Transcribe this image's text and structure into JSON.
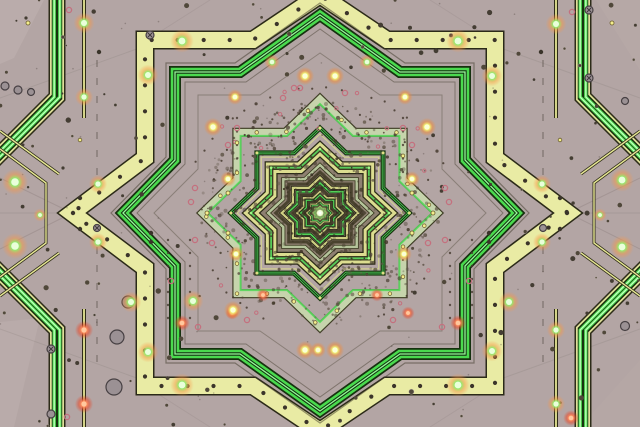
{
  "image": {
    "width": 640,
    "height": 427,
    "kind": "kaleidoscope-circuit-star-fractal"
  },
  "center": {
    "x": 320,
    "y": 213
  },
  "palette": {
    "background": "#b3a5a4",
    "background_inner": "#a89b9a",
    "yellow_band": "#e9eba4",
    "yellow_band_edge": "#2b2a18",
    "green_bright": "#4ada4e",
    "green_light": "#96fb9a",
    "green_dark": "#16320f",
    "sage_band": "#c6d4ac",
    "sage_edge": "#3a3a20",
    "thin_yellow": "#e6e794",
    "mottle_brown": "#8e8071",
    "inner_olive": "#5e5641",
    "center_glow": "#f2ffda",
    "glow_halo_warm": "#f08c3c",
    "pink_ring": "#c4707e",
    "gray_circle": "#9b9194",
    "dark_dot": "#443d33"
  },
  "gradients": {
    "glow_yellow": [
      "#ffffe0",
      "#f2fa7a",
      "rgba(240,140,60,0.55)",
      "rgba(240,140,60,0)"
    ],
    "glow_green": [
      "#f0ffd8",
      "#90ee70",
      "rgba(250,150,70,0.45)",
      "rgba(250,150,70,0)"
    ],
    "glow_red": [
      "#ffd8b8",
      "#ff9060",
      "rgba(230,70,40,0.5)",
      "rgba(230,70,40,0)"
    ],
    "center": [
      "#eaffc8",
      "rgba(168,216,122,0.35)",
      "rgba(168,216,122,0)"
    ]
  },
  "patches": [
    {
      "pts": [
        [
          0,
          0
        ],
        [
          44,
          0
        ],
        [
          14,
          58
        ],
        [
          0,
          64
        ]
      ],
      "c": "#c1b3b1",
      "op": 0.5
    },
    {
      "pts": [
        [
          0,
          322
        ],
        [
          40,
          318
        ],
        [
          14,
          427
        ],
        [
          0,
          427
        ]
      ],
      "c": "#bfb1af",
      "op": 0.5
    },
    {
      "pts": [
        [
          596,
          0
        ],
        [
          640,
          0
        ],
        [
          640,
          70
        ]
      ],
      "c": "#bbadab",
      "op": 0.4
    },
    {
      "pts": [
        [
          640,
          360
        ],
        [
          640,
          427
        ],
        [
          580,
          427
        ]
      ],
      "c": "#b9abaa",
      "op": 0.35
    }
  ],
  "seams": [
    [
      72,
      213,
      0,
      178,
      0.13
    ],
    [
      72,
      213,
      0,
      249,
      0.13
    ],
    [
      568,
      213,
      640,
      178,
      0.13
    ],
    [
      568,
      213,
      640,
      249,
      0.13
    ],
    [
      320,
      0,
      320,
      16,
      0.18
    ],
    [
      320,
      410,
      320,
      427,
      0.18
    ],
    [
      0,
      213,
      70,
      213,
      0.1
    ],
    [
      573,
      213,
      640,
      213,
      0.1
    ],
    [
      0,
      98,
      145,
      46,
      0.09
    ],
    [
      640,
      98,
      495,
      46,
      0.09
    ],
    [
      0,
      329,
      145,
      381,
      0.09
    ],
    [
      640,
      329,
      495,
      381,
      0.09
    ],
    [
      147,
      40,
      210,
      0,
      0.08
    ],
    [
      493,
      40,
      430,
      0,
      0.08
    ],
    [
      147,
      387,
      210,
      427,
      0.08
    ],
    [
      493,
      387,
      430,
      427,
      0.08
    ]
  ],
  "edge_right": {
    "thin_line": {
      "x": 556,
      "segs": [
        [
          -4,
          118
        ],
        [
          309,
          432
        ]
      ],
      "strokes": [
        [
          4,
          "#2f2c1a"
        ],
        [
          1.8,
          "#e6e794"
        ]
      ]
    },
    "dash_line": {
      "x": 543,
      "segs": [
        [
          60,
          180
        ],
        [
          247,
          367
        ]
      ],
      "w": 1.2,
      "c": "#4a4238",
      "dash": "7 11",
      "op": 0.5
    },
    "band_paths": [
      [
        [
          583,
          -4
        ],
        [
          583,
          97
        ],
        [
          650,
          164
        ]
      ],
      [
        [
          650,
          263
        ],
        [
          583,
          330
        ],
        [
          583,
          432
        ]
      ]
    ],
    "band_strokes": [
      [
        17,
        "#2c2c18"
      ],
      [
        14,
        "#dfe098"
      ],
      [
        10.5,
        "#17320e"
      ]
    ],
    "band_line_offset": 2.8,
    "band_line_strokes": [
      [
        3.2,
        "#57e75b"
      ],
      [
        1.1,
        "#ccffc6"
      ]
    ],
    "diagonals": [
      [
        [
          640,
          131
        ],
        [
          581,
          174
        ]
      ],
      [
        [
          640,
          149
        ],
        [
          594,
          183
        ],
        [
          594,
          243
        ],
        [
          640,
          277
        ]
      ],
      [
        [
          640,
          296
        ],
        [
          581,
          253
        ]
      ]
    ],
    "diag_strokes": [
      [
        3,
        "#2f2c1a"
      ],
      [
        1.4,
        "#e6e794"
      ]
    ]
  },
  "outer_rings": [
    {
      "A": 228,
      "dx": 70,
      "F": 181,
      "W": 183,
      "V": 58,
      "T": 259,
      "strokes": [
        [
          1.3,
          "#3e3828",
          0.55
        ]
      ]
    },
    {
      "A": 218,
      "dx": 67,
      "F": 173,
      "W": 175,
      "V": 55,
      "T": 248,
      "strokes": [
        [
          19,
          "#2b2a18"
        ],
        [
          16,
          "#e9eba4"
        ]
      ],
      "dots": {
        "step": 26,
        "r": 2.1,
        "c": "#3b342a"
      }
    },
    {
      "A": 210,
      "dx": 85,
      "F": 150,
      "W": 154,
      "V": 56,
      "T": 209,
      "strokes": [
        [
          1.2,
          "#3e3828",
          0.5
        ]
      ]
    },
    {
      "A": 198,
      "dx": 80,
      "F": 141,
      "W": 145,
      "V": 53,
      "T": 197,
      "strokes": [
        [
          12,
          "#16320f"
        ],
        [
          8.5,
          "#4ada4e"
        ],
        [
          3.4,
          "#133110"
        ],
        [
          1.3,
          "#96fb9a"
        ]
      ]
    },
    {
      "A": 184,
      "dx": 74,
      "F": 131,
      "W": 135,
      "V": 49,
      "T": 183,
      "strokes": [
        [
          1,
          "#3e3828",
          0.45
        ]
      ]
    },
    {
      "A": 160,
      "dx": 60,
      "F": 118,
      "W": 122,
      "V": 44,
      "T": 166,
      "strokes": [
        [
          1,
          "#3e3828",
          0.35
        ]
      ]
    }
  ],
  "fills": [
    {
      "R": 62,
      "c": "#8e8071"
    },
    {
      "R": 42,
      "c": "#7b6f5c"
    },
    {
      "R": 27,
      "c": "#6a6150"
    },
    {
      "R": 16,
      "c": "#5e5641"
    },
    {
      "R": 9,
      "c": "#575134"
    }
  ],
  "inner_rings": [
    {
      "R": 120,
      "s": 1.03,
      "strokes": [
        [
          1,
          "#3e3828",
          0.4
        ]
      ]
    },
    {
      "R": 114,
      "s": 1.03,
      "strokes": [
        [
          9,
          "#3a3a20"
        ],
        [
          7,
          "#c6d4ac"
        ]
      ],
      "path_dots": {
        "step": 30,
        "r": 1.8,
        "fill": "#f2ec8e",
        "stroke": "#6a5c30"
      }
    },
    {
      "R": 109,
      "s": 1.03,
      "strokes": [
        [
          2,
          "#58d85c",
          0.9
        ]
      ]
    },
    {
      "R": 85,
      "s": 1.05,
      "strokes": [
        [
          5,
          "#17320e"
        ],
        [
          2.6,
          "#4fc957"
        ],
        [
          0.9,
          "#0e2a0c"
        ]
      ],
      "tip_dots": {
        "r": 1.5,
        "c": "#f2ec8e"
      }
    },
    {
      "R": 79,
      "s": 1.05,
      "strokes": [
        [
          1.2,
          "#d8d98c",
          0.8
        ]
      ]
    },
    {
      "R": 64,
      "s": 1.08,
      "strokes": [
        [
          13,
          "#2b2a18"
        ],
        [
          10.5,
          "#dcdd90"
        ],
        [
          4.5,
          "#3c3a20"
        ],
        [
          1.8,
          "#57cb59"
        ]
      ],
      "path_dots": {
        "step": 13,
        "r": 0.8,
        "fill": "#3c3626"
      },
      "tip_dots": {
        "r": 1.3,
        "c": "#a8ff8c"
      }
    },
    {
      "R": 48,
      "s": 1.08,
      "strokes": [
        [
          4,
          "#333218"
        ],
        [
          2.5,
          "#b5c49b"
        ]
      ]
    },
    {
      "R": 41,
      "s": 1.08,
      "strokes": [
        [
          3,
          "#4a432f"
        ]
      ]
    },
    {
      "R": 35.5,
      "s": 1.08,
      "strokes": [
        [
          4,
          "#2b2918"
        ],
        [
          2.2,
          "#cfd084"
        ]
      ]
    },
    {
      "R": 30,
      "s": 1.08,
      "strokes": [
        [
          3,
          "#143010"
        ],
        [
          1.6,
          "#54d058"
        ]
      ]
    },
    {
      "R": 25.5,
      "s": 1.08,
      "strokes": [
        [
          2.5,
          "#453e2a"
        ]
      ]
    },
    {
      "R": 21.5,
      "s": 1.08,
      "strokes": [
        [
          3,
          "#2b2918"
        ],
        [
          1.6,
          "#c8c97e"
        ]
      ]
    },
    {
      "R": 18,
      "s": 1.08,
      "strokes": [
        [
          2.2,
          "#143010"
        ],
        [
          1.2,
          "#54d058"
        ]
      ]
    },
    {
      "R": 15,
      "s": 1.08,
      "strokes": [
        [
          2,
          "#453e2a"
        ]
      ]
    },
    {
      "R": 12.4,
      "s": 1.08,
      "strokes": [
        [
          2.2,
          "#2b2918"
        ],
        [
          1.2,
          "#c2c378"
        ]
      ]
    },
    {
      "R": 10.2,
      "s": 1.08,
      "strokes": [
        [
          1.8,
          "#143010"
        ],
        [
          1,
          "#58d05c"
        ]
      ]
    },
    {
      "R": 8.4,
      "s": 1.08,
      "strokes": [
        [
          1.5,
          "#40392a"
        ]
      ]
    },
    {
      "R": 6.8,
      "s": 1.08,
      "strokes": [
        [
          1.6,
          "#2b2918"
        ],
        [
          0.9,
          "#bcbd72"
        ]
      ]
    },
    {
      "R": 5.4,
      "s": 1.08,
      "strokes": [
        [
          1.4,
          "#143010"
        ],
        [
          0.8,
          "#58d05c"
        ]
      ]
    },
    {
      "R": 4.3,
      "s": 1.08,
      "strokes": [
        [
          1.2,
          "#3a3426"
        ]
      ]
    },
    {
      "R": 3.4,
      "s": 1.08,
      "strokes": [
        [
          1.2,
          "#2b2918"
        ],
        [
          0.7,
          "#b6b76c"
        ]
      ]
    },
    {
      "R": 2.6,
      "s": 1.08,
      "strokes": [
        [
          1,
          "#343022"
        ]
      ]
    },
    {
      "R": 1.9,
      "s": 1.08,
      "strokes": [
        [
          1,
          "#4ec455"
        ]
      ]
    }
  ],
  "chains": {
    "arcs": [
      [
        320,
        216,
        108,
        200,
        340,
        26
      ],
      [
        320,
        216,
        128,
        205,
        335,
        22
      ],
      [
        320,
        216,
        88,
        215,
        325,
        15
      ],
      [
        320,
        216,
        115,
        118,
        152,
        9
      ],
      [
        320,
        216,
        115,
        28,
        62,
        9
      ]
    ],
    "lines": [
      [
        403,
        118,
        403,
        172,
        5
      ],
      [
        237,
        118,
        237,
        172,
        5
      ],
      [
        168,
        240,
        168,
        318,
        7
      ],
      [
        190,
        240,
        190,
        318,
        7
      ],
      [
        472,
        240,
        472,
        318,
        7
      ],
      [
        450,
        240,
        450,
        318,
        7
      ]
    ]
  },
  "dots": {
    "glow_green": [
      [
        84,
        23,
        4
      ],
      [
        84,
        97,
        3.5
      ],
      [
        15,
        182,
        5
      ],
      [
        15,
        246,
        5
      ],
      [
        98,
        184,
        3.5
      ],
      [
        98,
        242,
        3.5
      ],
      [
        148,
        75,
        4
      ],
      [
        182,
        41,
        4.5
      ],
      [
        131,
        302,
        4
      ],
      [
        148,
        352,
        4
      ],
      [
        182,
        385,
        4.5
      ],
      [
        272,
        62,
        3
      ],
      [
        367,
        62,
        3
      ],
      [
        600,
        215,
        2.5
      ],
      [
        40,
        215,
        2.5
      ],
      [
        622,
        180,
        4.5
      ],
      [
        622,
        247,
        4.5
      ],
      [
        556,
        24,
        4
      ],
      [
        556,
        330,
        3.5
      ],
      [
        556,
        404,
        3.5
      ],
      [
        492,
        76,
        4
      ],
      [
        492,
        351,
        4
      ],
      [
        542,
        184,
        3.5
      ],
      [
        542,
        242,
        3.5
      ],
      [
        458,
        41,
        4.5
      ],
      [
        509,
        302,
        4
      ],
      [
        458,
        385,
        4.5
      ],
      [
        193,
        301,
        4
      ]
    ],
    "glow_yellow": [
      [
        305,
        76,
        3.5
      ],
      [
        335,
        76,
        3.5
      ],
      [
        305,
        350,
        3.5
      ],
      [
        318,
        350,
        3
      ],
      [
        335,
        350,
        3.5
      ],
      [
        213,
        127,
        3.5
      ],
      [
        235,
        97,
        3
      ],
      [
        233,
        310,
        3.5
      ],
      [
        405,
        97,
        3
      ],
      [
        427,
        127,
        3.5
      ],
      [
        412,
        179,
        3
      ],
      [
        228,
        179,
        3
      ],
      [
        404,
        254,
        3
      ],
      [
        236,
        254,
        3
      ]
    ],
    "glow_red": [
      [
        84,
        330,
        3.5
      ],
      [
        84,
        404,
        3.5
      ],
      [
        571,
        418,
        3
      ],
      [
        182,
        323,
        3
      ],
      [
        458,
        323,
        3
      ],
      [
        263,
        295,
        2.5
      ],
      [
        377,
        295,
        2.5
      ],
      [
        232,
        313,
        2.5
      ],
      [
        408,
        313,
        2.5
      ]
    ],
    "pink_rings": [
      [
        69,
        10
      ],
      [
        572,
        12
      ],
      [
        67,
        417
      ],
      [
        294,
        88
      ],
      [
        300,
        88
      ],
      [
        283,
        98
      ],
      [
        345,
        93
      ],
      [
        403,
        128
      ],
      [
        237,
        128
      ],
      [
        412,
        145
      ],
      [
        228,
        145
      ],
      [
        445,
        188
      ],
      [
        195,
        188
      ],
      [
        445,
        240
      ],
      [
        195,
        240
      ],
      [
        212,
        243
      ],
      [
        428,
        243
      ],
      [
        171,
        281
      ],
      [
        469,
        281
      ],
      [
        247,
        320
      ],
      [
        393,
        320
      ],
      [
        198,
        327
      ],
      [
        442,
        327
      ],
      [
        449,
        202
      ],
      [
        191,
        202
      ]
    ],
    "yellow_rings": [
      [
        612,
        23,
        2
      ],
      [
        28,
        23,
        2
      ],
      [
        412,
        193,
        2
      ],
      [
        412,
        233,
        2
      ],
      [
        433,
        213,
        2
      ],
      [
        228,
        193,
        2
      ],
      [
        228,
        233,
        2
      ],
      [
        207,
        213,
        2
      ],
      [
        560,
        140,
        1.8
      ],
      [
        80,
        140,
        1.8
      ]
    ],
    "gray_circles": [
      [
        5,
        86,
        4,
        0
      ],
      [
        18,
        90,
        4,
        0
      ],
      [
        31,
        92,
        3.5,
        0
      ],
      [
        589,
        10,
        4,
        1
      ],
      [
        589,
        78,
        4,
        1
      ],
      [
        625,
        326,
        4.5,
        0
      ],
      [
        51,
        349,
        4,
        1
      ],
      [
        51,
        414,
        4,
        0
      ],
      [
        128,
        302,
        6,
        0
      ],
      [
        117,
        337,
        7,
        0
      ],
      [
        114,
        387,
        8,
        0
      ],
      [
        150,
        35,
        4,
        1
      ],
      [
        97,
        228,
        3.5,
        1
      ],
      [
        543,
        228,
        3.5,
        0
      ],
      [
        625,
        101,
        3.5,
        0
      ]
    ],
    "dark_medium": [
      [
        560,
        198
      ],
      [
        560,
        229
      ],
      [
        567,
        213
      ],
      [
        80,
        198
      ],
      [
        80,
        229
      ],
      [
        73,
        213
      ],
      [
        541,
        52
      ],
      [
        99,
        52
      ],
      [
        489,
        233
      ],
      [
        489,
        242
      ],
      [
        151,
        233
      ],
      [
        151,
        242
      ]
    ]
  },
  "center_glow": {
    "halo_r": 10,
    "ring_r": 5,
    "core_r": 3,
    "spark_r": 1.4
  },
  "generation": {
    "speckle_seed": 13,
    "speckle_count": 650,
    "speckle_core_count": 150,
    "scatter_seed": 7,
    "scatter_count": 140,
    "tiny_count": 60
  }
}
